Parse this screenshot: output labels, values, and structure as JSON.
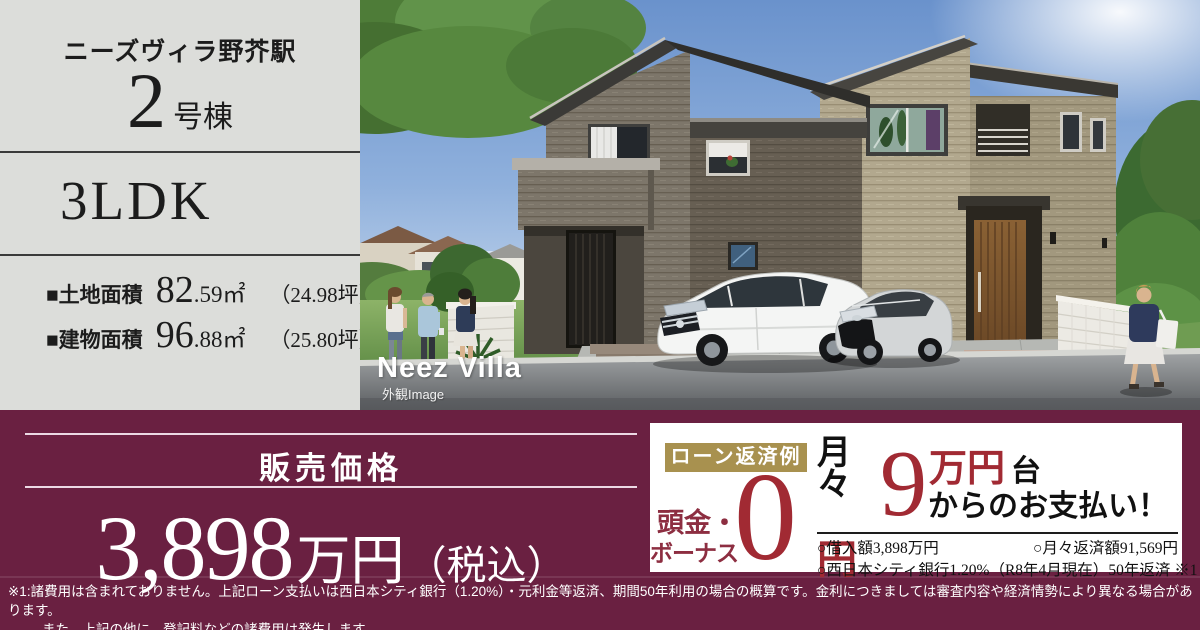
{
  "left_panel": {
    "property_name": "ニーズヴィラ野芥駅",
    "unit_number": "2",
    "unit_suffix": "号棟",
    "floor_plan": "3LDK",
    "areas": [
      {
        "label": "■土地面積",
        "value_main": "82",
        "value_sub": ".59㎡",
        "tsubo": "（24.98坪）"
      },
      {
        "label": "■建物面積",
        "value_main": "96",
        "value_sub": ".88㎡",
        "tsubo": "（25.80坪）"
      }
    ]
  },
  "photo": {
    "logo": "Neez Villa",
    "caption": "外観Image"
  },
  "price": {
    "label": "販売価格",
    "value": "3,898",
    "unit": "万円",
    "tax_note": "（税込）"
  },
  "loan": {
    "badge": "ローン返済例",
    "down_label_line1": "頭金・",
    "down_label_line2": "ボーナス",
    "down_value": "0",
    "down_unit": "円",
    "monthly_char1": "月",
    "monthly_char2": "々",
    "monthly_value": "9",
    "monthly_unit": "万円",
    "monthly_suffix": "台",
    "monthly_tagline": "からのお支払い！",
    "details": [
      {
        "left": "○借入額3,898万円",
        "right": "○月々返済額91,569円"
      },
      {
        "left": "○西日本シティ銀行1.20%（R8年4月現在）",
        "right": "50年返済 ※1"
      }
    ]
  },
  "footnotes": [
    "※1:諸費用は含まれておりません。上記ローン支払いは西日本シティ銀行（1.20%）・元利金等返済、期間50年利用の場合の概算です。金利につきましては審査内容や経済情勢により異なる場合があります。",
    "また、上記の他に、登記料などの諸費用は発生します。"
  ],
  "colors": {
    "band_maroon": "#6a2041",
    "accent_red": "#a12a33",
    "deep_red": "#8d2e41",
    "badge_gold": "#a8914f",
    "panel_gray": "#dcddda"
  }
}
